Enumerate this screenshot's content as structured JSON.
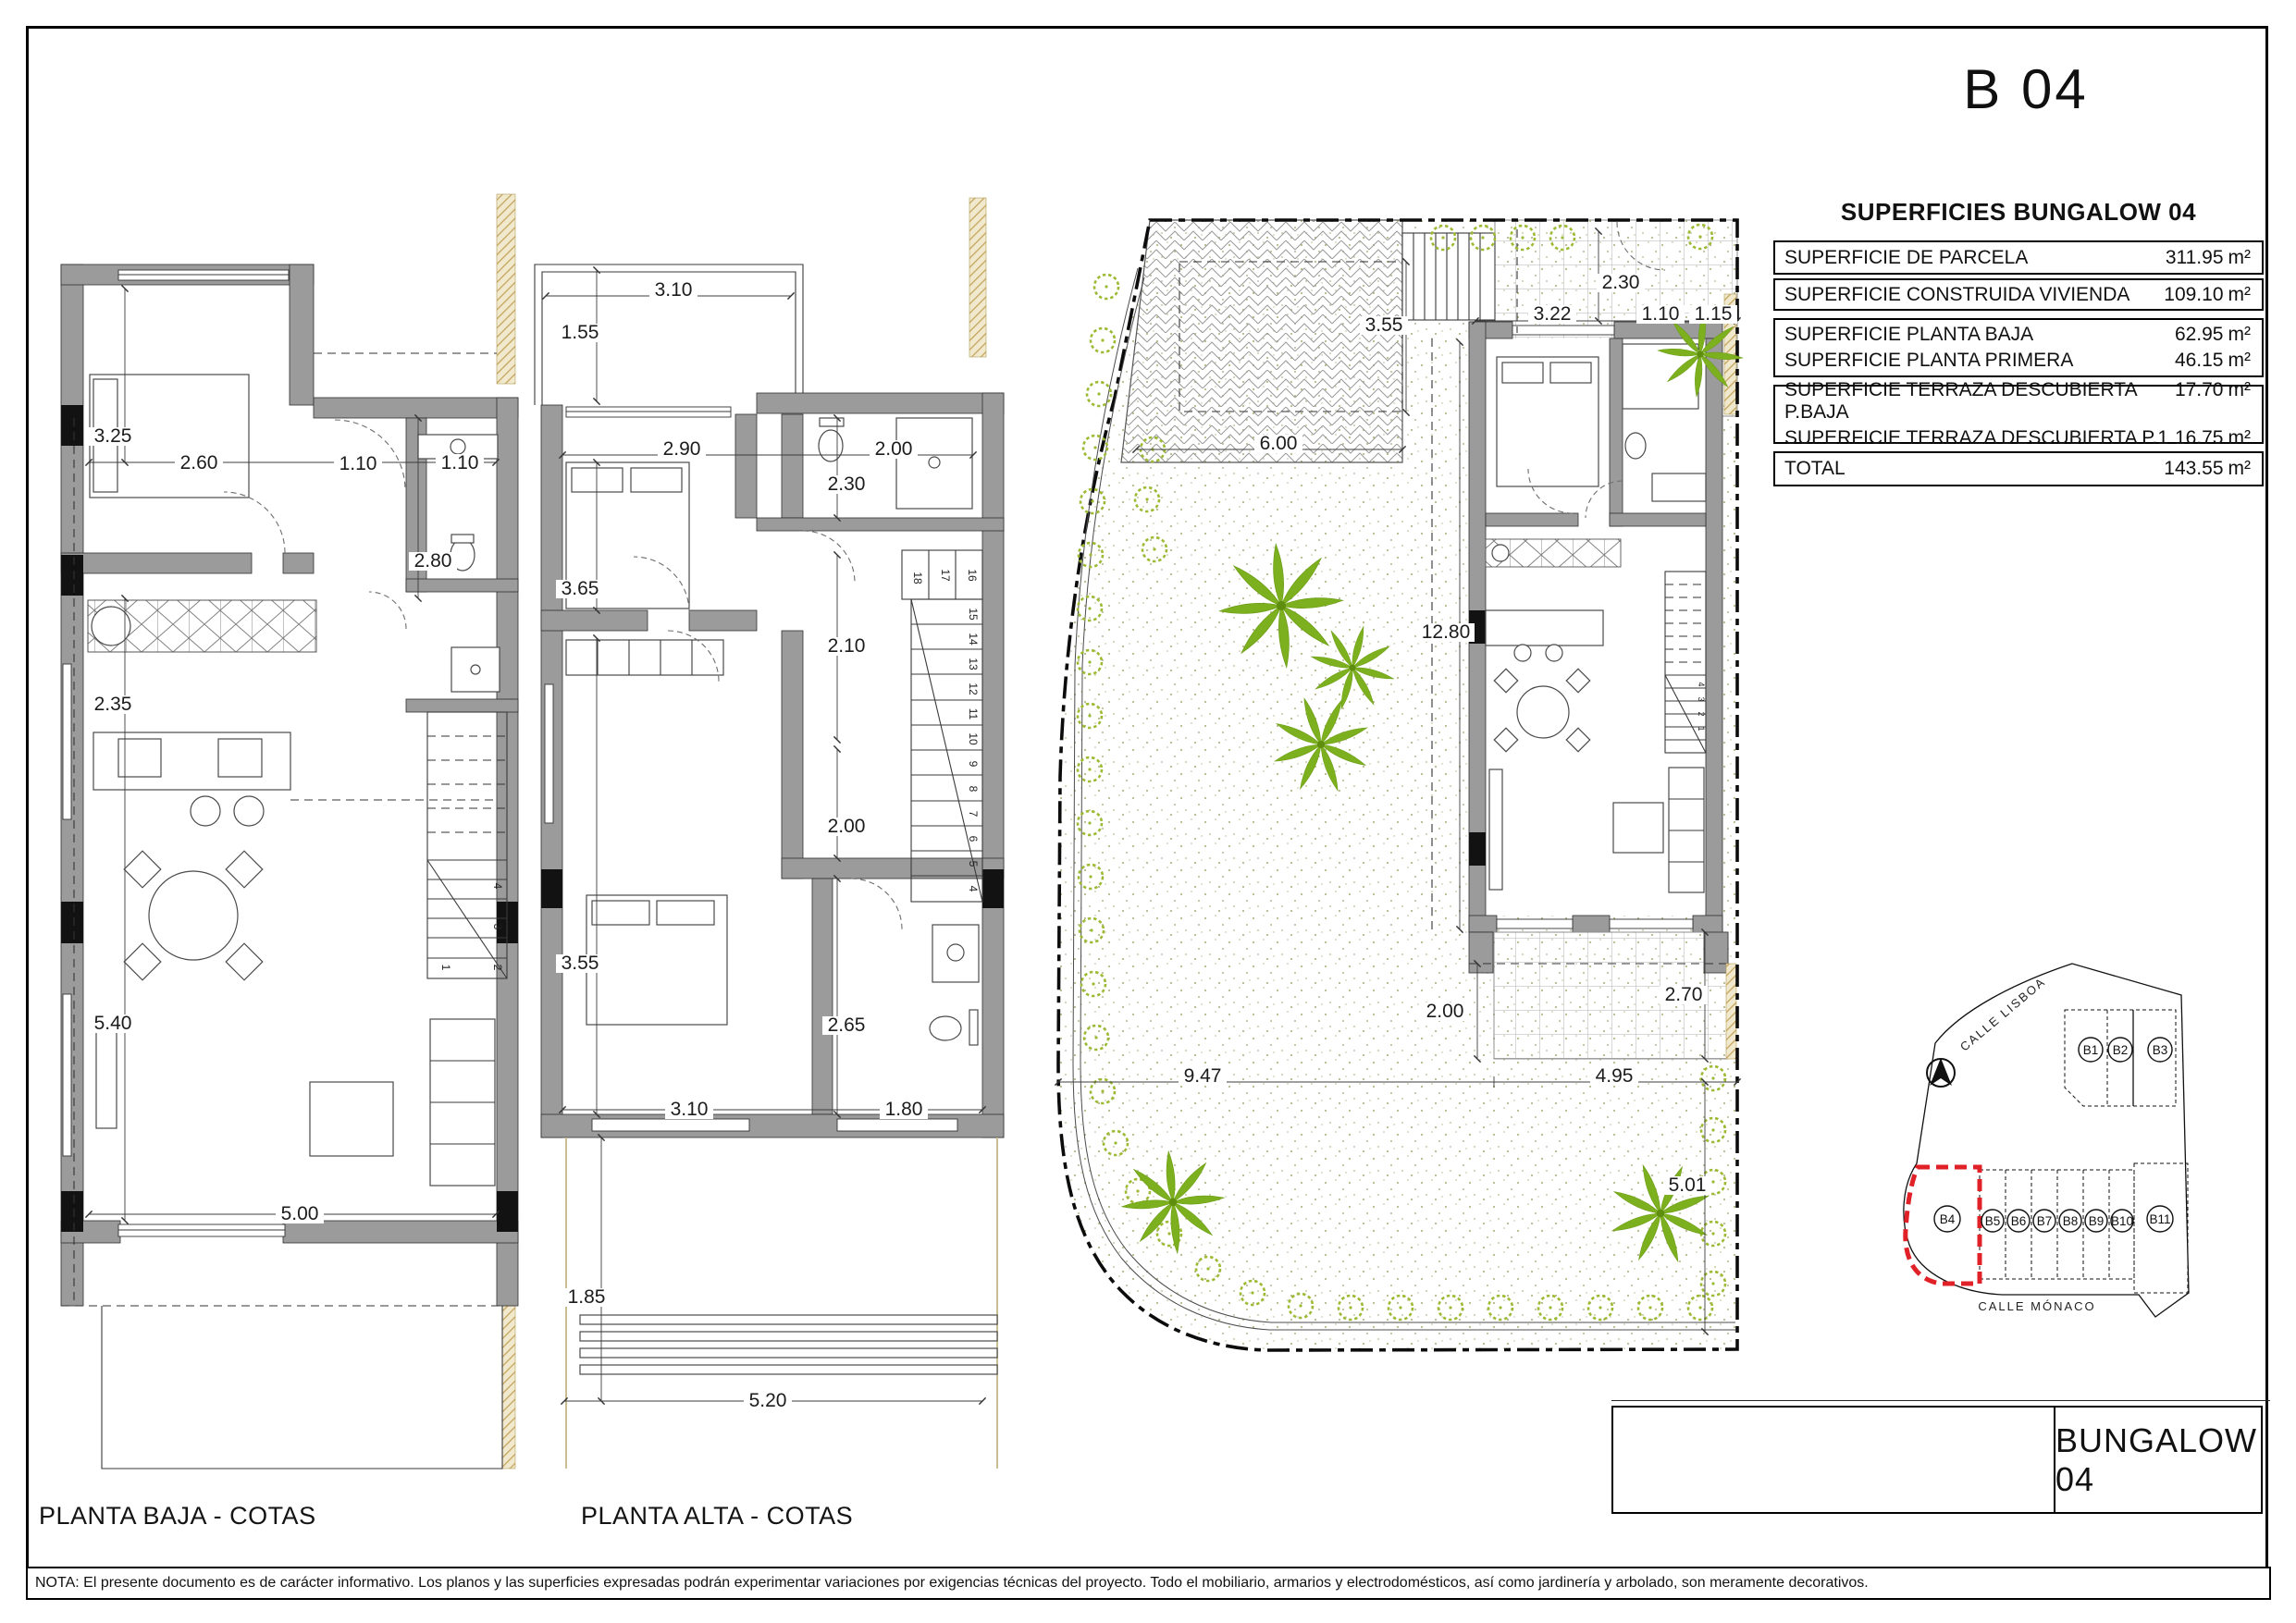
{
  "page": {
    "code": "B 04",
    "sheet_title": "BUNGALOW 04",
    "note": "NOTA: El presente documento es de carácter informativo. Los planos y las superficies expresadas podrán experimentar variaciones por exigencias técnicas del proyecto. Todo el mobiliario, armarios y electrodomésticos, así como jardinería y arbolado, son meramente decorativos."
  },
  "surfaces": {
    "title": "SUPERFICIES BUNGALOW 04",
    "unit": "m²",
    "groups": [
      {
        "rows": [
          {
            "label": "SUPERFICIE DE PARCELA",
            "value": "311.95"
          }
        ]
      },
      {
        "rows": [
          {
            "label": "SUPERFICIE CONSTRUIDA VIVIENDA",
            "value": "109.10"
          }
        ]
      },
      {
        "rows": [
          {
            "label": "SUPERFICIE PLANTA BAJA",
            "value": "62.95"
          },
          {
            "label": "SUPERFICIE PLANTA PRIMERA",
            "value": "46.15"
          }
        ]
      },
      {
        "rows": [
          {
            "label": "SUPERFICIE TERRAZA DESCUBIERTA P.BAJA",
            "value": "17.70"
          },
          {
            "label": "SUPERFICIE TERRAZA DESCUBIERTA P.1",
            "value": "16.75"
          }
        ]
      },
      {
        "rows": [
          {
            "label": "TOTAL",
            "value": "143.55"
          }
        ]
      }
    ]
  },
  "plans": {
    "pb": {
      "label": "PLANTA BAJA - COTAS"
    },
    "pa": {
      "label": "PLANTA ALTA - COTAS"
    }
  },
  "dims": {
    "pb": [
      "3.25",
      "2.60",
      "1.10",
      "1.10",
      "2.80",
      "2.35",
      "5.40",
      "5.00"
    ],
    "pa": [
      "3.10",
      "1.55",
      "2.90",
      "2.00",
      "2.30",
      "3.65",
      "2.10",
      "2.00",
      "3.55",
      "2.65",
      "3.10",
      "1.80",
      "1.85",
      "5.20"
    ],
    "st": [
      "2.30",
      "3.55",
      "3.22",
      "1.10",
      "1.15",
      "6.00",
      "12.80",
      "2.00",
      "2.70",
      "9.47",
      "4.95",
      "5.01"
    ]
  },
  "stairs": {
    "pb": [
      "1",
      "2",
      "3",
      "4"
    ],
    "paTop": [
      "18",
      "17",
      "16"
    ],
    "paRun": [
      "15",
      "14",
      "13",
      "12",
      "11",
      "10",
      "9",
      "8",
      "7",
      "6",
      "5",
      "4"
    ],
    "house": [
      "4",
      "3",
      "2",
      "1"
    ]
  },
  "map": {
    "street_top": "CALLE LISBOA",
    "street_bottom": "CALLE MÓNACO",
    "plots": [
      "B1",
      "B2",
      "B3",
      "B4",
      "B5",
      "B6",
      "B7",
      "B8",
      "B9",
      "B10",
      "B11"
    ],
    "highlight_color": "#e02127"
  }
}
